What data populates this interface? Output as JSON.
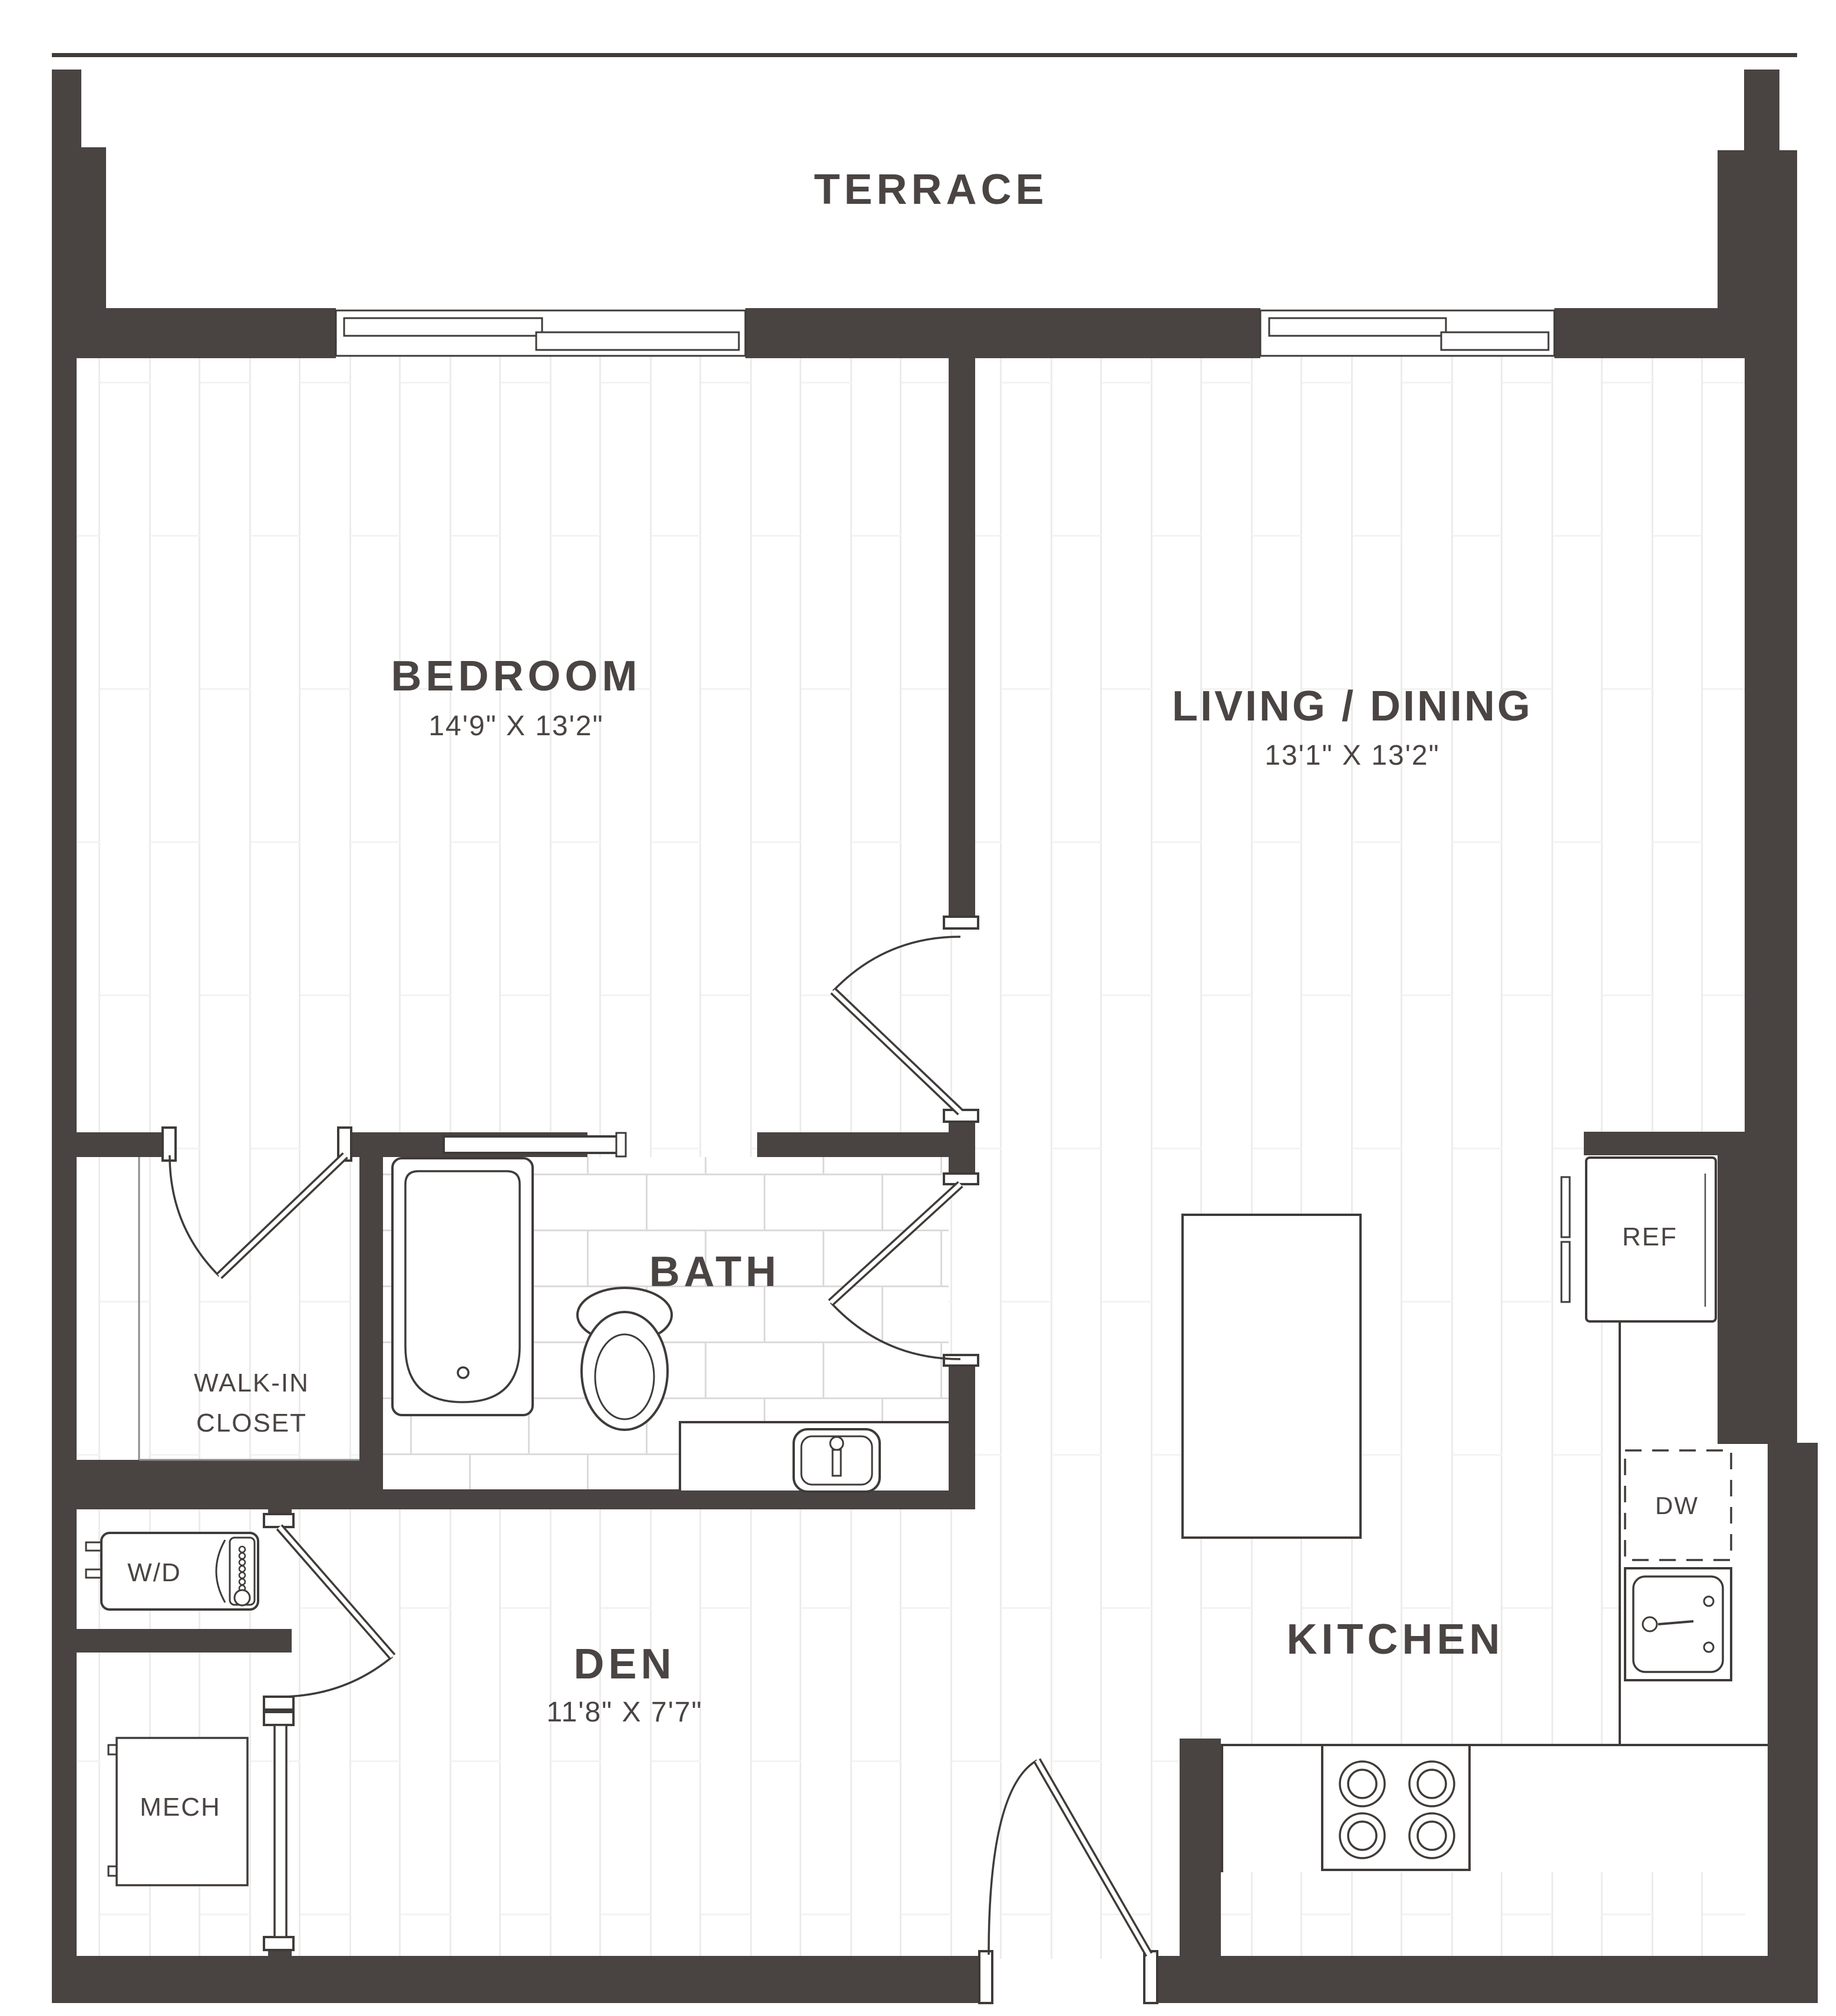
{
  "type": "floor_plan",
  "labels": {
    "terrace": "TERRACE",
    "bedroom": "BEDROOM",
    "bedroom_dims": "14'9\" X 13'2\"",
    "living": "LIVING / DINING",
    "living_dims": "13'1\" X 13'2\"",
    "bath": "BATH",
    "closet_line1": "WALK-IN",
    "closet_line2": "CLOSET",
    "wd": "W/D",
    "mech": "MECH",
    "den": "DEN",
    "den_dims": "11'8\" X 7'7\"",
    "kitchen": "KITCHEN",
    "ref": "REF",
    "dw": "DW"
  },
  "rooms": [
    {
      "name": "Terrace",
      "dimensions": ""
    },
    {
      "name": "Bedroom",
      "dimensions": "14'9\" X 13'2\""
    },
    {
      "name": "Living / Dining",
      "dimensions": "13'1\" X 13'2\""
    },
    {
      "name": "Bath",
      "dimensions": ""
    },
    {
      "name": "Walk-in Closet",
      "dimensions": ""
    },
    {
      "name": "W/D",
      "dimensions": ""
    },
    {
      "name": "Mech",
      "dimensions": ""
    },
    {
      "name": "Den",
      "dimensions": "11'8\" X 7'7\""
    },
    {
      "name": "Kitchen",
      "dimensions": ""
    }
  ],
  "colors": {
    "wall": "#494341",
    "line": "#3f3b39",
    "text": "#4a4443",
    "plank_line": "#ececec",
    "tile_line": "#dcdada",
    "background": "#ffffff"
  }
}
